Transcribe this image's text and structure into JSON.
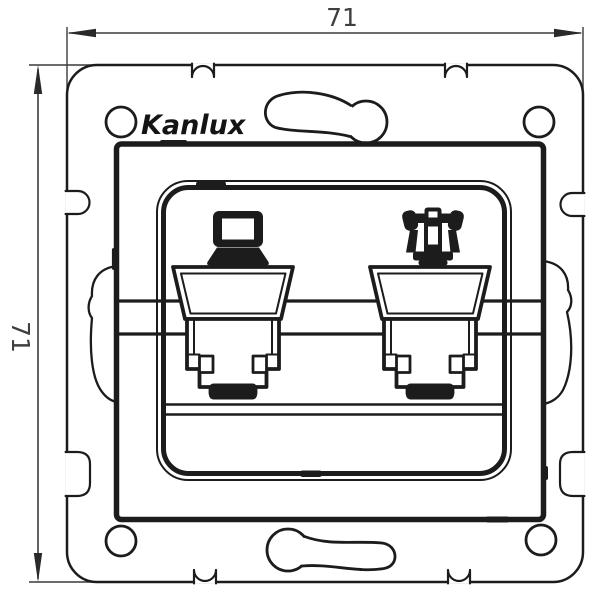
{
  "drawing": {
    "brand": "Kanlux",
    "dimensions": {
      "width": "71",
      "height": "71"
    },
    "colors": {
      "line": "#1c1c1c",
      "dimension_text": "#3f3f3f",
      "background": "#ffffff"
    },
    "sockets": [
      {
        "position": "left",
        "icon": "computer-icon"
      },
      {
        "position": "right",
        "icon": "phone-icon"
      }
    ]
  }
}
